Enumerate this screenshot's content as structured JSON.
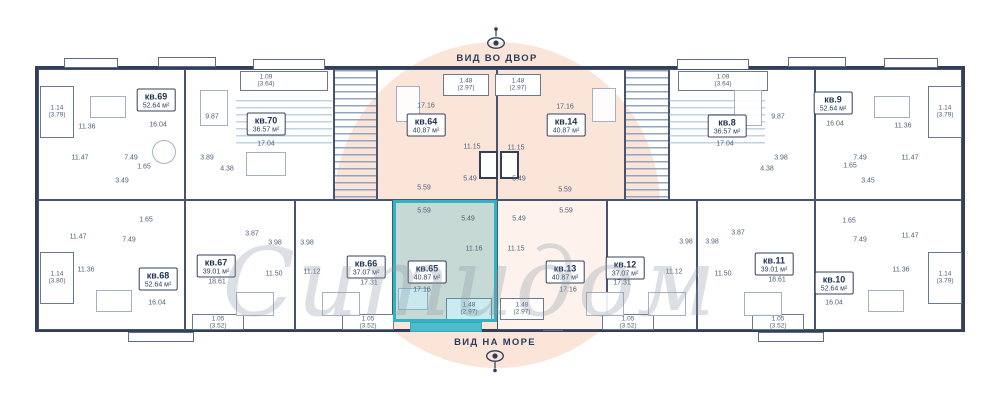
{
  "watermark": "Ситидом",
  "views": {
    "courtyard": "ВИД ВО ДВОР",
    "sea": "ВИД НА МОРЕ"
  },
  "colors": {
    "accent": "#2fb4c6",
    "highlight_fill": "#c3e7ea",
    "peach": "#fbe5d9",
    "wall": "#333f59",
    "room_text": "#4e6078",
    "watermark": "#aab3c0"
  },
  "apartments": {
    "kv69": {
      "id": "кв.69",
      "area": "52.64 м²",
      "rooms": [
        "11.36",
        "16.04",
        "11.47",
        "7.49",
        "1.65",
        "3.49"
      ],
      "balcony": [
        "1.14",
        "(3.79)"
      ],
      "highlighted": false
    },
    "kv70": {
      "id": "кв.70",
      "area": "36.57 м²",
      "rooms": [
        "9.87",
        "17.04",
        "3.89",
        "4.38"
      ],
      "balcony": [
        "1.09",
        "(3.64)"
      ],
      "highlighted": false
    },
    "kv64": {
      "id": "кв.64",
      "area": "40.87 м²",
      "rooms": [
        "17.16",
        "11.15",
        "5.49",
        "5.59"
      ],
      "balcony": [
        "1.48",
        "(2.97)"
      ],
      "highlighted": false
    },
    "kv14": {
      "id": "кв.14",
      "area": "40.87 м²",
      "rooms": [
        "17.16",
        "11.15",
        "5.49",
        "5.59"
      ],
      "balcony": [
        "1.48",
        "(2.97)"
      ],
      "highlighted": false
    },
    "kv8": {
      "id": "кв.8",
      "area": "36.57 м²",
      "rooms": [
        "17.04",
        "9.87",
        "3.98",
        "4.38"
      ],
      "balcony": [
        "1.09",
        "(3.64)"
      ],
      "highlighted": false
    },
    "kv9": {
      "id": "кв.9",
      "area": "52.64 м²",
      "rooms": [
        "16.04",
        "11.36",
        "7.49",
        "11.47",
        "1.65",
        "3.45"
      ],
      "balcony": [
        "1.14",
        "(3.79)"
      ],
      "highlighted": false
    },
    "kv68": {
      "id": "кв.68",
      "area": "52.64 м²",
      "rooms": [
        "11.47",
        "7.49",
        "1.65",
        "11.36",
        "16.04"
      ],
      "balcony": [
        "1.14",
        "(3.80)"
      ],
      "highlighted": false
    },
    "kv67": {
      "id": "кв.67",
      "area": "39.01 м²",
      "rooms": [
        "18.61",
        "11.50",
        "3.98",
        "3.87"
      ],
      "balcony": [
        "1.05",
        "(3.52)"
      ],
      "highlighted": false
    },
    "kv66": {
      "id": "кв.66",
      "area": "37.07 м²",
      "rooms": [
        "17.31",
        "11.12",
        "3.98"
      ],
      "balcony": [
        "1.05",
        "(3.52)"
      ],
      "highlighted": false
    },
    "kv65": {
      "id": "кв.65",
      "area": "40.87 м²",
      "rooms": [
        "17.16",
        "11.16",
        "5.49",
        "5.59"
      ],
      "balcony": [
        "1.48",
        "(2.97)"
      ],
      "highlighted": true
    },
    "kv13": {
      "id": "кв.13",
      "area": "40.87 м²",
      "rooms": [
        "17.16",
        "11.15",
        "5.49",
        "5.59"
      ],
      "balcony": [
        "1.48",
        "(2.97)"
      ],
      "highlighted": false
    },
    "kv12": {
      "id": "кв.12",
      "area": "37.07 м²",
      "rooms": [
        "17.31",
        "11.12",
        "3.98"
      ],
      "balcony": [
        "1.05",
        "(3.52)"
      ],
      "highlighted": false
    },
    "kv11": {
      "id": "кв.11",
      "area": "39.01 м²",
      "rooms": [
        "18.61",
        "11.50",
        "3.98",
        "3.87"
      ],
      "balcony": [
        "1.05",
        "(3.52)"
      ],
      "highlighted": false
    },
    "kv10": {
      "id": "кв.10",
      "area": "52.64 м²",
      "rooms": [
        "16.04",
        "11.36",
        "11.47",
        "7.49",
        "1.65"
      ],
      "balcony": [
        "1.14",
        "(3.79)"
      ],
      "highlighted": false
    }
  }
}
